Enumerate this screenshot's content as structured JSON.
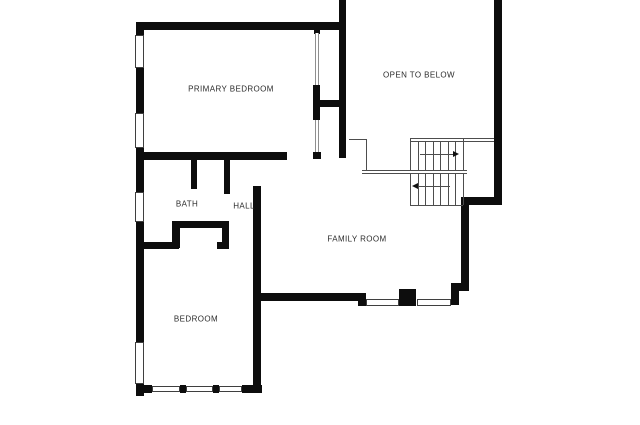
{
  "colors": {
    "background": "#ffffff",
    "wall": "#0d0d0d",
    "stair_line": "#4d4d4d",
    "window_border": "#3f3f3f",
    "label_text": "#2b2b2b"
  },
  "rooms": [
    {
      "id": "primary-bedroom",
      "label": "PRIMARY BEDROOM",
      "cx": 231,
      "cy": 89
    },
    {
      "id": "open-to-below",
      "label": "OPEN TO BELOW",
      "cx": 419,
      "cy": 75
    },
    {
      "id": "bath",
      "label": "BATH",
      "cx": 187,
      "cy": 204
    },
    {
      "id": "hall",
      "label": "HALL",
      "cx": 244,
      "cy": 206
    },
    {
      "id": "family-room",
      "label": "FAMILY ROOM",
      "cx": 357,
      "cy": 239
    },
    {
      "id": "bedroom",
      "label": "BEDROOM",
      "cx": 196,
      "cy": 319
    }
  ],
  "floorplan": {
    "canvas": {
      "width": 640,
      "height": 425
    },
    "walls": [
      [
        137,
        22,
        209,
        8
      ],
      [
        136,
        22,
        8,
        374
      ],
      [
        339,
        0,
        7,
        158
      ],
      [
        494,
        0,
        8,
        205
      ],
      [
        461,
        197,
        41,
        8
      ],
      [
        461,
        197,
        8,
        92
      ],
      [
        451,
        283,
        18,
        8
      ],
      [
        451,
        291,
        8,
        14
      ],
      [
        314,
        26,
        6,
        8
      ],
      [
        313,
        85,
        7,
        35
      ],
      [
        318,
        100,
        28,
        7
      ],
      [
        313,
        152,
        8,
        7
      ],
      [
        136,
        152,
        151,
        8
      ],
      [
        191,
        160,
        6,
        29
      ],
      [
        224,
        160,
        6,
        34
      ],
      [
        172,
        221,
        57,
        7
      ],
      [
        172,
        228,
        8,
        20
      ],
      [
        222,
        228,
        7,
        20
      ],
      [
        140,
        242,
        39,
        7
      ],
      [
        217,
        242,
        12,
        7
      ],
      [
        253,
        186,
        8,
        207
      ],
      [
        256,
        293,
        109,
        8
      ],
      [
        358,
        293,
        8,
        13
      ],
      [
        136,
        385,
        16,
        8
      ],
      [
        180,
        385,
        6,
        8
      ],
      [
        213,
        385,
        6,
        8
      ],
      [
        242,
        385,
        20,
        8
      ]
    ],
    "windows": [
      [
        135,
        35,
        9,
        33
      ],
      [
        135,
        113,
        9,
        35
      ],
      [
        135,
        192,
        9,
        30
      ],
      [
        135,
        342,
        9,
        42
      ],
      [
        366,
        299,
        33,
        7
      ],
      [
        417,
        299,
        34,
        7
      ],
      [
        152,
        386,
        28,
        6
      ],
      [
        186,
        386,
        27,
        6
      ],
      [
        219,
        386,
        23,
        6
      ]
    ],
    "channels": [
      [
        315,
        33,
        4,
        52
      ],
      [
        315,
        120,
        4,
        32
      ]
    ],
    "fireplace": [
      399,
      289,
      17,
      17
    ],
    "stairs": {
      "lines": [
        [
          410,
          138,
          494,
          138
        ],
        [
          410,
          141,
          494,
          141
        ],
        [
          410,
          138,
          410,
          205
        ],
        [
          463,
          138,
          463,
          205
        ],
        [
          410,
          205,
          463,
          205
        ],
        [
          418,
          141,
          418,
          170
        ],
        [
          425,
          141,
          425,
          170
        ],
        [
          433,
          141,
          433,
          170
        ],
        [
          440,
          141,
          440,
          170
        ],
        [
          448,
          141,
          448,
          170
        ],
        [
          455,
          141,
          455,
          170
        ],
        [
          418,
          174,
          418,
          205
        ],
        [
          425,
          174,
          425,
          205
        ],
        [
          433,
          174,
          433,
          205
        ],
        [
          440,
          174,
          440,
          205
        ],
        [
          448,
          174,
          448,
          205
        ],
        [
          455,
          174,
          455,
          205
        ],
        [
          349,
          139,
          367,
          139
        ],
        [
          366,
          139,
          366,
          171
        ],
        [
          420,
          154,
          453,
          154
        ],
        [
          418,
          186,
          450,
          186
        ]
      ],
      "landing": [
        362,
        170,
        105,
        4
      ],
      "arrow_heads": [
        {
          "x": 459,
          "y": 154,
          "dir": "right"
        },
        {
          "x": 412,
          "y": 186,
          "dir": "left"
        }
      ]
    }
  }
}
